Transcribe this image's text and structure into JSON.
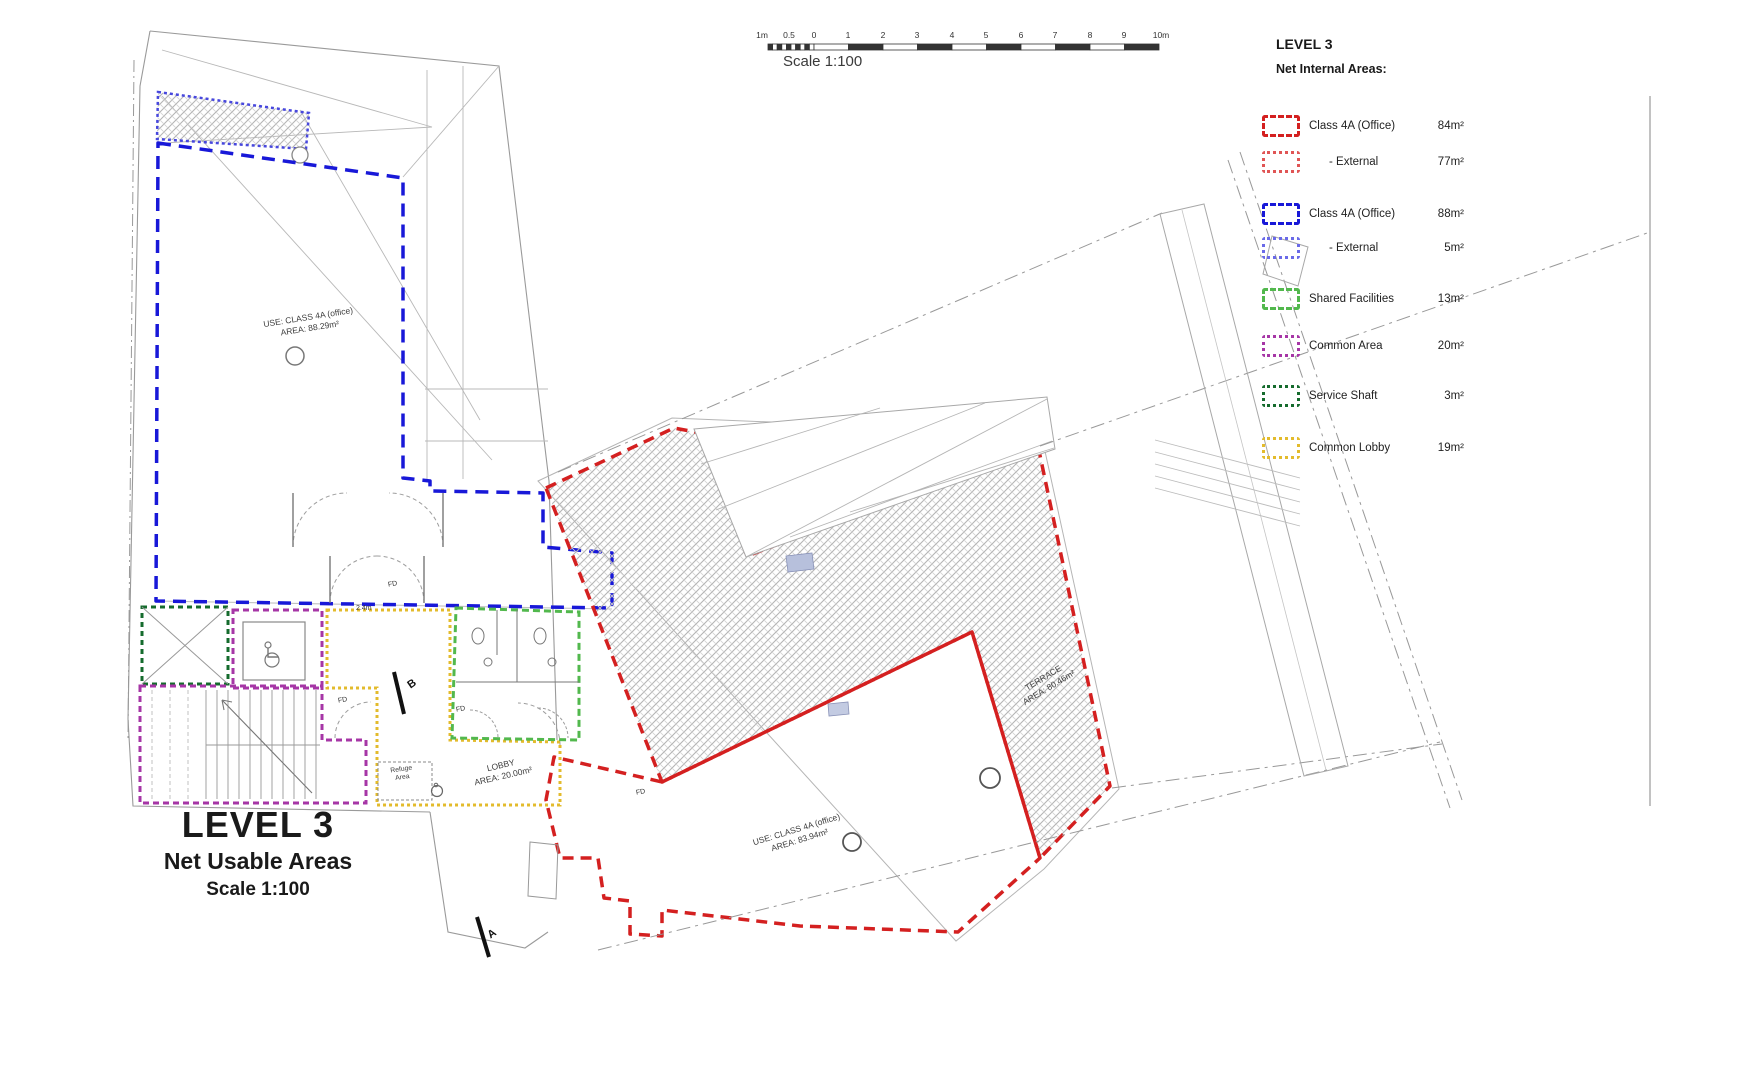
{
  "scalebar": {
    "labels": [
      "1m",
      "0.5",
      "0",
      "1",
      "2",
      "3",
      "4",
      "5",
      "6",
      "7",
      "8",
      "9",
      "10m"
    ],
    "caption": "Scale 1:100"
  },
  "legend": {
    "title": "LEVEL 3",
    "subtitle": "Net Internal Areas:",
    "items": [
      {
        "label": "Class 4A (Office)",
        "value": "84m²",
        "color": "#d42020",
        "line": "dashed"
      },
      {
        "label": "- External",
        "value": "77m²",
        "color": "#e05555",
        "line": "dotted"
      },
      {
        "label": "Class 4A (Office)",
        "value": "88m²",
        "color": "#1818d8",
        "line": "dashed"
      },
      {
        "label": "- External",
        "value": "5m²",
        "color": "#6a6ae8",
        "line": "dotted"
      },
      {
        "label": "Shared Facilities",
        "value": "13m²",
        "color": "#52b84d",
        "line": "dashed"
      },
      {
        "label": "Common Area",
        "value": "20m²",
        "color": "#a636a6",
        "line": "dotted"
      },
      {
        "label": "Service Shaft",
        "value": "3m²",
        "color": "#156b2d",
        "line": "dotted"
      },
      {
        "label": "Common Lobby",
        "value": "19m²",
        "color": "#e3bb2c",
        "line": "dotted"
      }
    ]
  },
  "title_block": {
    "line1": "LEVEL 3",
    "line2": "Net Usable Areas",
    "line3": "Scale 1:100"
  },
  "rooms": {
    "office_left": {
      "line1": "USE: CLASS 4A (office)",
      "line2": "AREA: 88.29m²"
    },
    "office_right": {
      "line1": "USE: CLASS 4A (office)",
      "line2": "AREA: 83.94m²"
    },
    "terrace": {
      "line1": "TERRACE",
      "line2": "AREA: 80.46m²"
    },
    "lobby": {
      "line1": "LOBBY",
      "line2": "AREA: 20.00m²"
    },
    "refuge": {
      "line1": "Refuge",
      "line2": "Area"
    }
  },
  "annotations": {
    "fire_door": "FD",
    "section_a": "A",
    "section_b": "B",
    "dim_lobby": "2.4m"
  }
}
